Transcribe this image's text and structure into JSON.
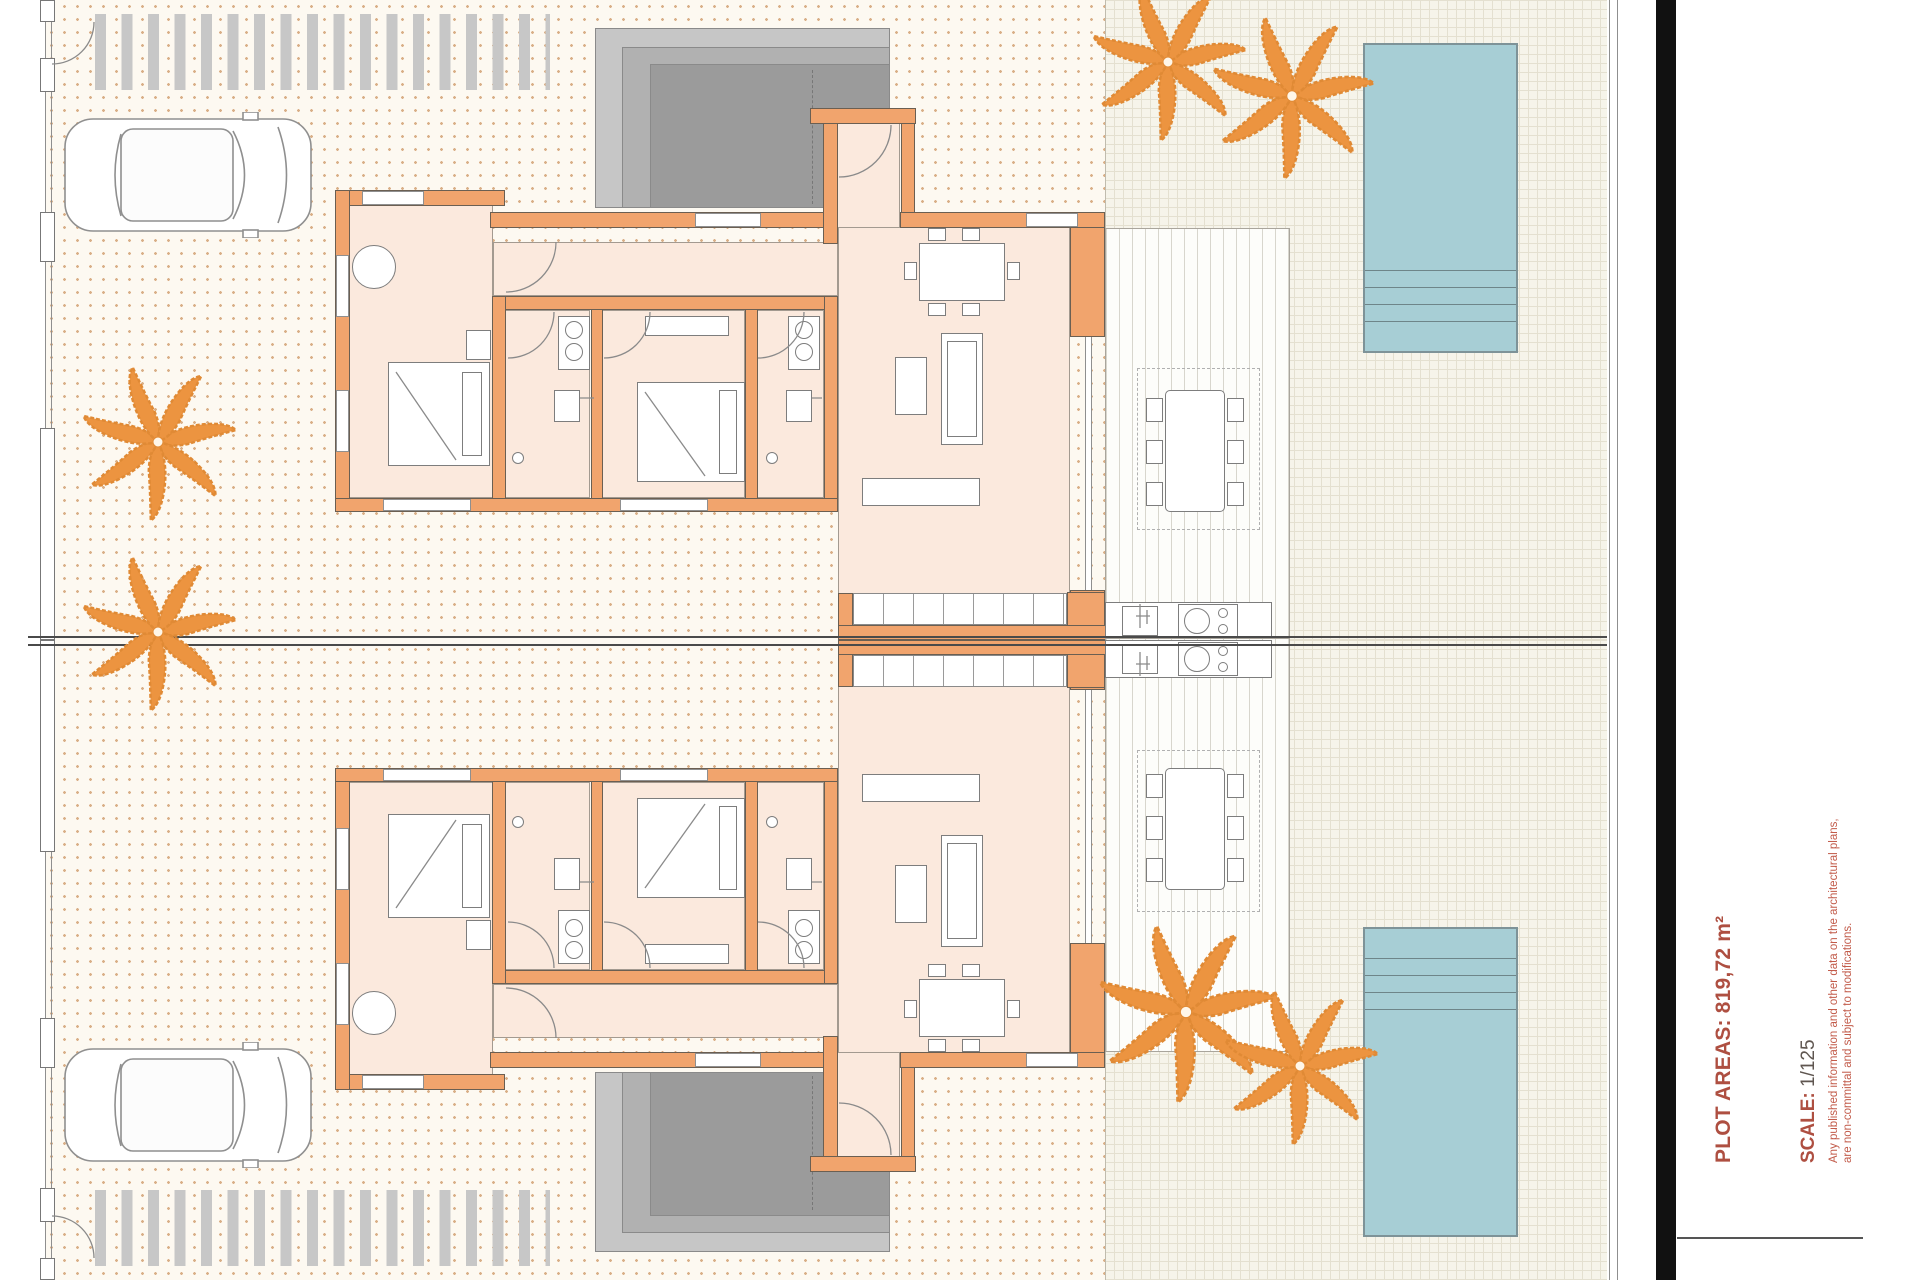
{
  "title_block": {
    "plot_areas_label": "PLOT AREAS:",
    "plot_areas_value": " 819,72 m²",
    "scale_label": "SCALE:",
    "scale_value": " 1/125",
    "disclaimer_line1": "Any published information and other data on the architectural plans,",
    "disclaimer_line2": "are non-committal and subject to modifications."
  },
  "colors": {
    "wall": "#f1a46d",
    "floor": "#fbe9dd",
    "dotBg": "#fdf9f1",
    "dot": "#d9af87",
    "woven": "#f6f4ea",
    "wovenLine": "#e4e0d0",
    "deckLine": "#d8d6cd",
    "stripe": "#c7c7c7",
    "pool": "#a7ced5",
    "palm": "#ec9440",
    "divide": "#4a4a4a",
    "accent": "#ae4f41",
    "disclaimer": "#c25b4a"
  }
}
